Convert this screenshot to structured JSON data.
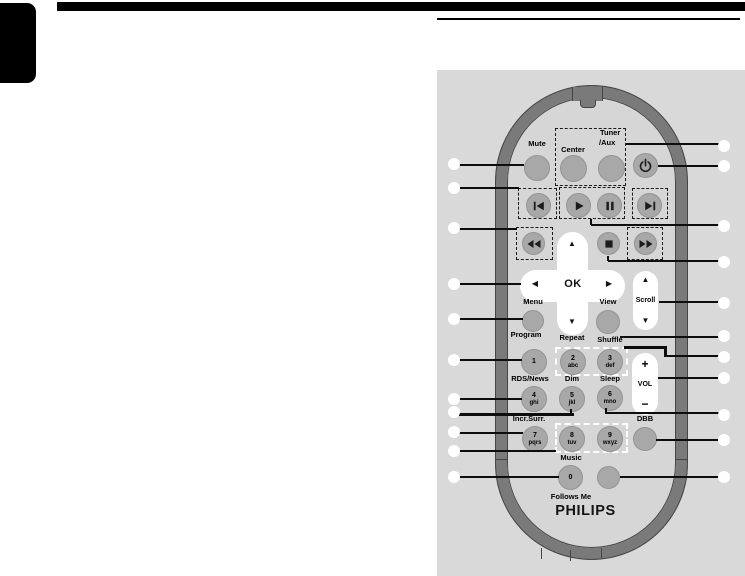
{
  "remote": {
    "brand": "PHILIPS",
    "labels": {
      "mute": "Mute",
      "center": "Center",
      "tuner_line1": "Tuner",
      "tuner_line2": "/Aux",
      "menu": "Menu",
      "view": "View",
      "scroll": "Scroll",
      "program": "Program",
      "repeat": "Repeat",
      "shuffle": "Shuffle",
      "rds_news": "RDS/News",
      "dim": "Dim",
      "sleep": "Sleep",
      "incr_surr": "Incr.Surr.",
      "dbb": "DBB",
      "music": "Music",
      "follows_me": "Follows Me",
      "vol": "VOL",
      "vol_plus": "+",
      "vol_minus": "−",
      "ok": "OK"
    },
    "nav": {
      "up": "▲",
      "down": "▼",
      "left": "◀",
      "right": "▶"
    },
    "scroll_arrows": {
      "up": "▲",
      "down": "▼"
    },
    "keypad": {
      "k1": {
        "digit": "1",
        "letters": ""
      },
      "k2": {
        "digit": "2",
        "letters": "abc"
      },
      "k3": {
        "digit": "3",
        "letters": "def"
      },
      "k4": {
        "digit": "4",
        "letters": "ghi"
      },
      "k5": {
        "digit": "5",
        "letters": "jkl"
      },
      "k6": {
        "digit": "6",
        "letters": "mno"
      },
      "k7": {
        "digit": "7",
        "letters": "pqrs"
      },
      "k8": {
        "digit": "8",
        "letters": "tuv"
      },
      "k9": {
        "digit": "9",
        "letters": "wxyz"
      },
      "k0": {
        "digit": "0",
        "letters": ""
      }
    },
    "colors": {
      "panel_bg": "#d9d9d9",
      "ring": "#7a7a7a",
      "button": "#a8a8a8",
      "callout_line": "#0d0d0d"
    }
  }
}
